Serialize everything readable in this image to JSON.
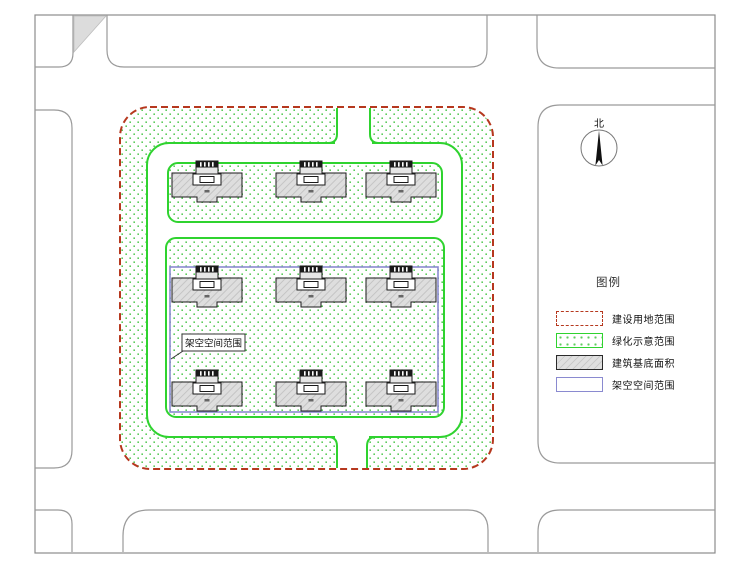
{
  "north": {
    "label": "北"
  },
  "callout": {
    "label": "架空空间范围"
  },
  "legend": {
    "title": "图例",
    "items": [
      {
        "key": "construction-land-boundary",
        "label": "建设用地范围",
        "swatch": "red-dashed"
      },
      {
        "key": "greenery-indication-range",
        "label": "绿化示意范围",
        "swatch": "green-dotted"
      },
      {
        "key": "building-footprint-area",
        "label": "建筑基底面积",
        "swatch": "gray-hatched"
      },
      {
        "key": "elevated-open-space-range",
        "label": "架空空间范围",
        "swatch": "blue-outline"
      }
    ]
  },
  "site": {
    "building_count": 9,
    "building_rows": 3,
    "building_cols": 3
  },
  "colors": {
    "site_boundary_red": "#b6381e",
    "greenery_green": "#2fd32f",
    "green_dot": "#5ecb5e",
    "building_fill": "#dedede",
    "building_outline": "#1a1a1a",
    "elevated_space_blue": "#8a8ad0",
    "road_line_gray": "#9a9a9a",
    "frame_gray": "#8c8c8c",
    "shaded_triangle_gray": "#dcdcdc"
  }
}
